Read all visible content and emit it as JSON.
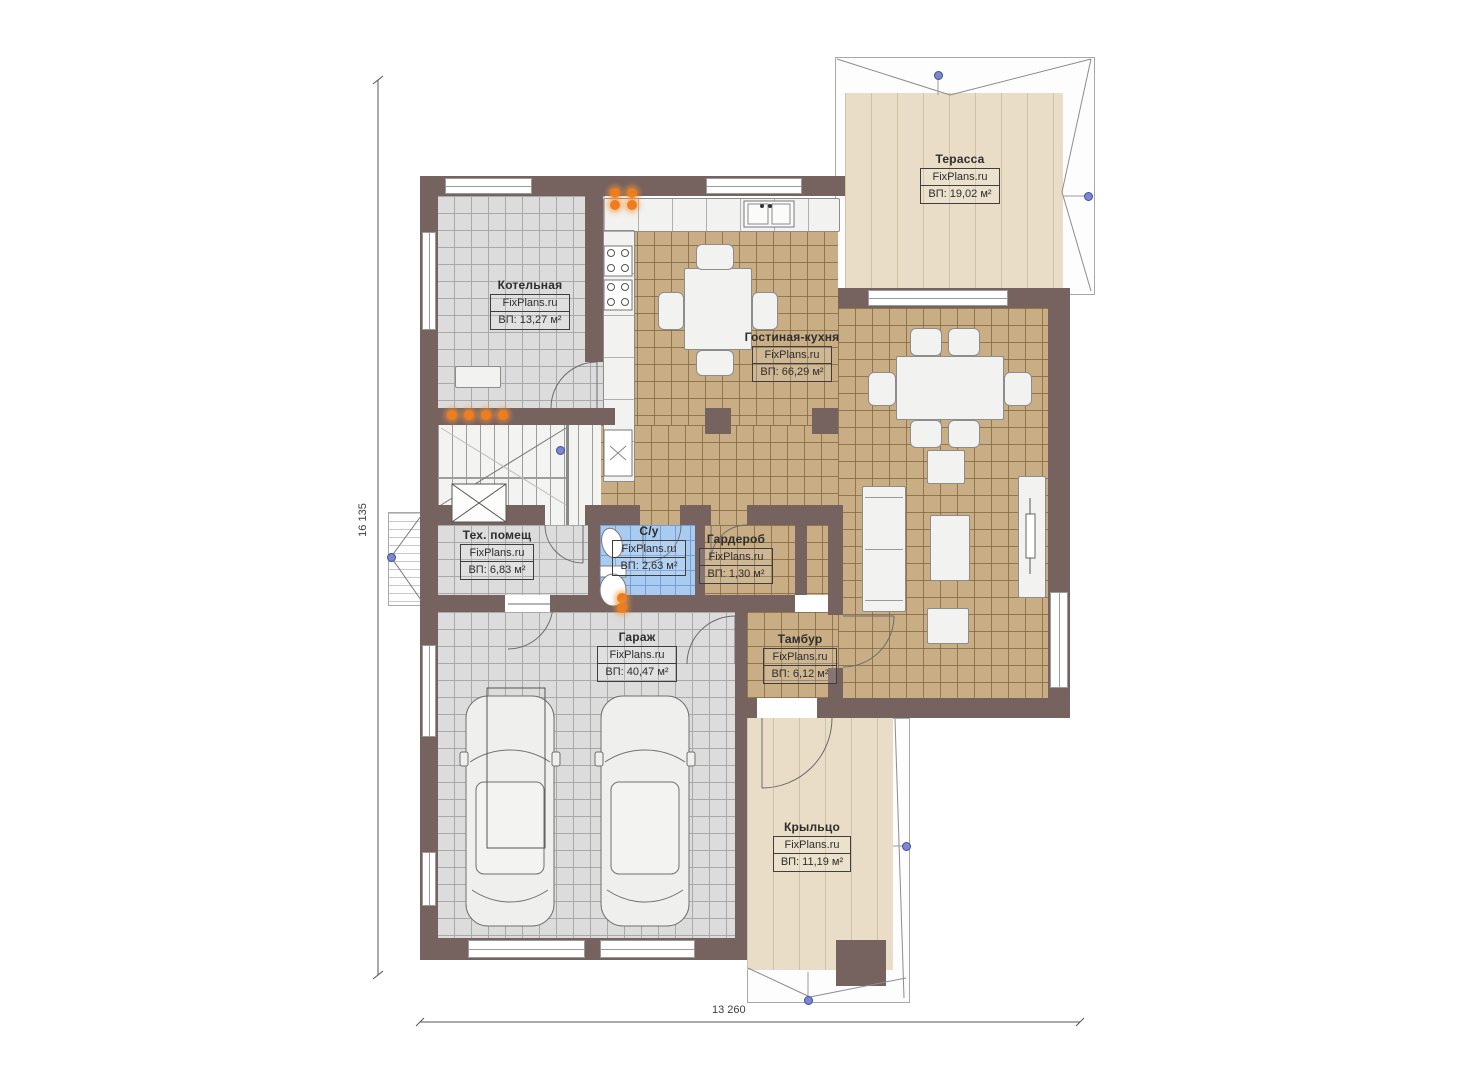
{
  "plan": {
    "watermark": "FixPlans.ru",
    "dimensions": {
      "bottom": "13 260",
      "left": "16 135"
    },
    "rooms": [
      {
        "id": "terrace",
        "name": "Терасса",
        "watermark": "FixPlans.ru",
        "area": "ВП: 19,02 м²"
      },
      {
        "id": "boiler",
        "name": "Котельная",
        "watermark": "FixPlans.ru",
        "area": "ВП: 13,27 м²"
      },
      {
        "id": "living-kitchen",
        "name": "Гостиная-кухня",
        "watermark": "FixPlans.ru",
        "area": "ВП: 66,29 м²"
      },
      {
        "id": "tech",
        "name": "Тех. помещ",
        "watermark": "FixPlans.ru",
        "area": "ВП: 6,83 м²"
      },
      {
        "id": "bathroom",
        "name": "С/у",
        "watermark": "FixPlans.ru",
        "area": "ВП: 2,63 м²"
      },
      {
        "id": "wardrobe",
        "name": "Гардероб",
        "watermark": "FixPlans.ru",
        "area": "ВП: 1,30 м²"
      },
      {
        "id": "garage",
        "name": "Гараж",
        "watermark": "FixPlans.ru",
        "area": "ВП: 40,47 м²"
      },
      {
        "id": "vestibule",
        "name": "Тамбур",
        "watermark": "FixPlans.ru",
        "area": "ВП: 6,12 м²"
      },
      {
        "id": "porch",
        "name": "Крыльцо",
        "watermark": "FixPlans.ru",
        "area": "ВП: 11,19 м²"
      }
    ],
    "colors": {
      "wall": "#76625f",
      "floor_gray": "#dcdcdc",
      "floor_tan": "#c9ae85",
      "floor_blue": "#aacbf0",
      "deck_beige": "#e9ddc7",
      "radiator": "#ef7d1d",
      "marker_blue": "#7b87cf"
    }
  }
}
